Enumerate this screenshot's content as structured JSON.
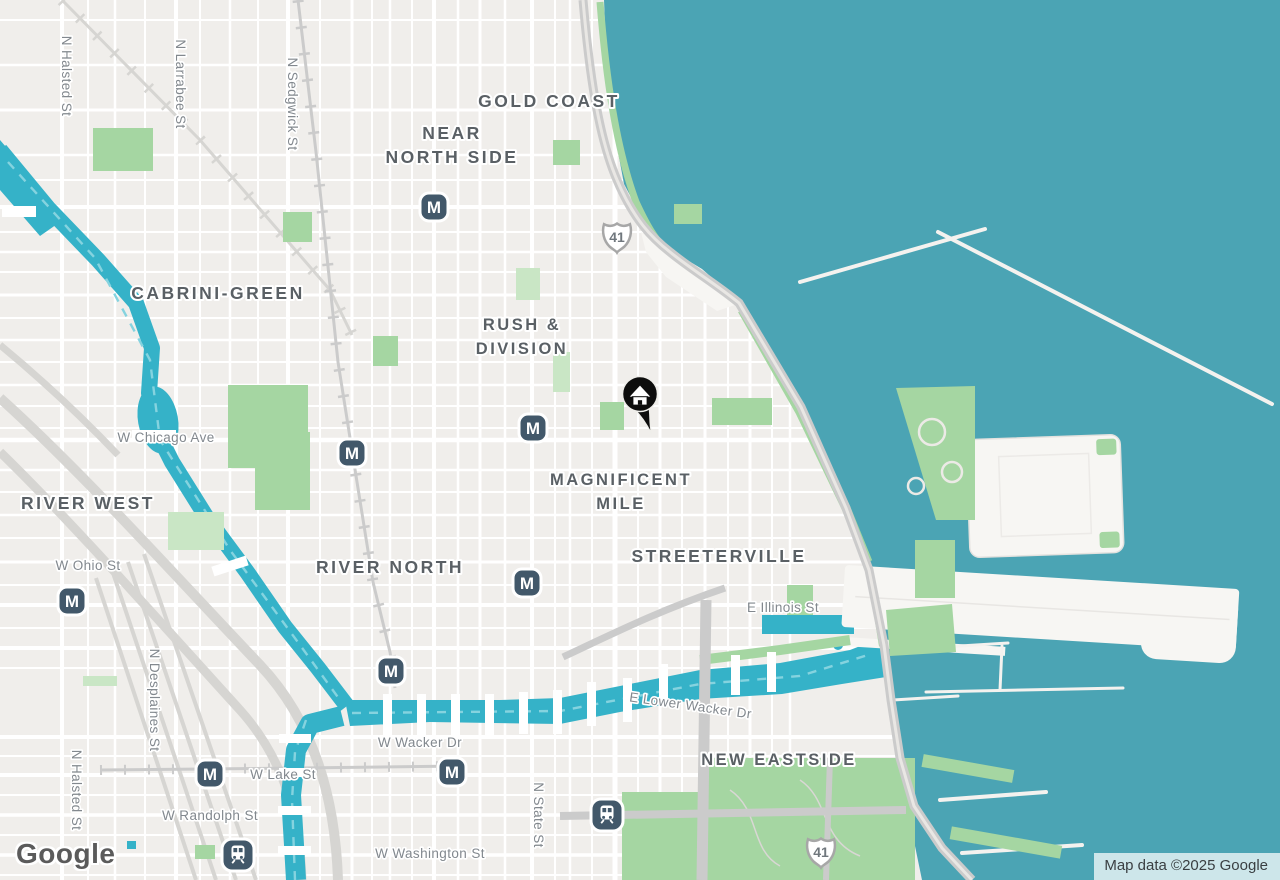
{
  "map": {
    "provider_logo": "Google",
    "attribution": "Map data ©2025 Google",
    "colors": {
      "land": "#F0EEEB",
      "water_lake": "#4BA4B4",
      "water_river": "#35B2C8",
      "park": "#A5D6A2",
      "park_pale": "#C9E6C5",
      "road": "#FFFFFF",
      "major_gray_road": "#C9C9C9",
      "transit_marker": "#42586A",
      "home_marker": "#0D0D0D",
      "neighborhood_label": "#5A6065",
      "street_label": "#82888E",
      "attribution_text": "#3A3F42",
      "logo_text": "#5B5B5B"
    },
    "neighborhoods": [
      {
        "lines": [
          "GOLD COAST"
        ],
        "x": 549,
        "y": 107,
        "size": 17.5
      },
      {
        "lines": [
          "NEAR",
          "NORTH SIDE"
        ],
        "x": 452,
        "y": 139,
        "size": 17.5
      },
      {
        "lines": [
          "CABRINI-GREEN"
        ],
        "x": 218,
        "y": 299,
        "size": 17.5
      },
      {
        "lines": [
          "RUSH &",
          "DIVISION"
        ],
        "x": 522,
        "y": 330,
        "size": 16.5
      },
      {
        "lines": [
          "MAGNIFICENT",
          "MILE"
        ],
        "x": 621,
        "y": 485,
        "size": 16.5
      },
      {
        "lines": [
          "RIVER WEST"
        ],
        "x": 88,
        "y": 509,
        "size": 17.5
      },
      {
        "lines": [
          "RIVER NORTH"
        ],
        "x": 390,
        "y": 573,
        "size": 17.5
      },
      {
        "lines": [
          "STREETERVILLE"
        ],
        "x": 719,
        "y": 562,
        "size": 17.5
      },
      {
        "lines": [
          "NEW EASTSIDE"
        ],
        "x": 779,
        "y": 765,
        "size": 16.5
      }
    ],
    "streets": [
      {
        "label": "N Halsted St",
        "x": 62,
        "y": 76,
        "rot": 90
      },
      {
        "label": "N Larrabee St",
        "x": 176,
        "y": 84,
        "rot": 90
      },
      {
        "label": "N Sedgwick St",
        "x": 288,
        "y": 104,
        "rot": 90
      },
      {
        "label": "W Chicago Ave",
        "x": 166,
        "y": 442,
        "rot": 0
      },
      {
        "label": "W Ohio St",
        "x": 88,
        "y": 570,
        "rot": 0
      },
      {
        "label": "E Illinois St",
        "x": 783,
        "y": 612,
        "rot": 0
      },
      {
        "label": "E Lower Wacker Dr",
        "x": 690,
        "y": 710,
        "rot": 8
      },
      {
        "label": "W Wacker Dr",
        "x": 420,
        "y": 747,
        "rot": 0
      },
      {
        "label": "N Desplaines St",
        "x": 150,
        "y": 700,
        "rot": 90
      },
      {
        "label": "N Halsted St",
        "x": 72,
        "y": 790,
        "rot": 90
      },
      {
        "label": "W Lake St",
        "x": 283,
        "y": 779,
        "rot": 0
      },
      {
        "label": "W Randolph St",
        "x": 210,
        "y": 820,
        "rot": 0
      },
      {
        "label": "W Washington St",
        "x": 430,
        "y": 858,
        "rot": 0
      },
      {
        "label": "N State St",
        "x": 534,
        "y": 815,
        "rot": 90
      }
    ],
    "highway_shields": [
      {
        "label": "41",
        "x": 617,
        "y": 237
      },
      {
        "label": "41",
        "x": 821,
        "y": 852
      }
    ],
    "metro_stations": [
      {
        "x": 434,
        "y": 207
      },
      {
        "x": 352,
        "y": 453
      },
      {
        "x": 533,
        "y": 428
      },
      {
        "x": 72,
        "y": 601
      },
      {
        "x": 527,
        "y": 583
      },
      {
        "x": 391,
        "y": 671
      },
      {
        "x": 210,
        "y": 774
      },
      {
        "x": 452,
        "y": 772
      }
    ],
    "rail_stations": [
      {
        "x": 238,
        "y": 855
      },
      {
        "x": 607,
        "y": 815
      }
    ],
    "home_marker": {
      "x": 640,
      "y": 394
    },
    "icons": {
      "metro": "metro-m-icon",
      "rail": "train-icon",
      "home": "house-pin-icon",
      "shield": "us-route-shield-icon"
    }
  }
}
